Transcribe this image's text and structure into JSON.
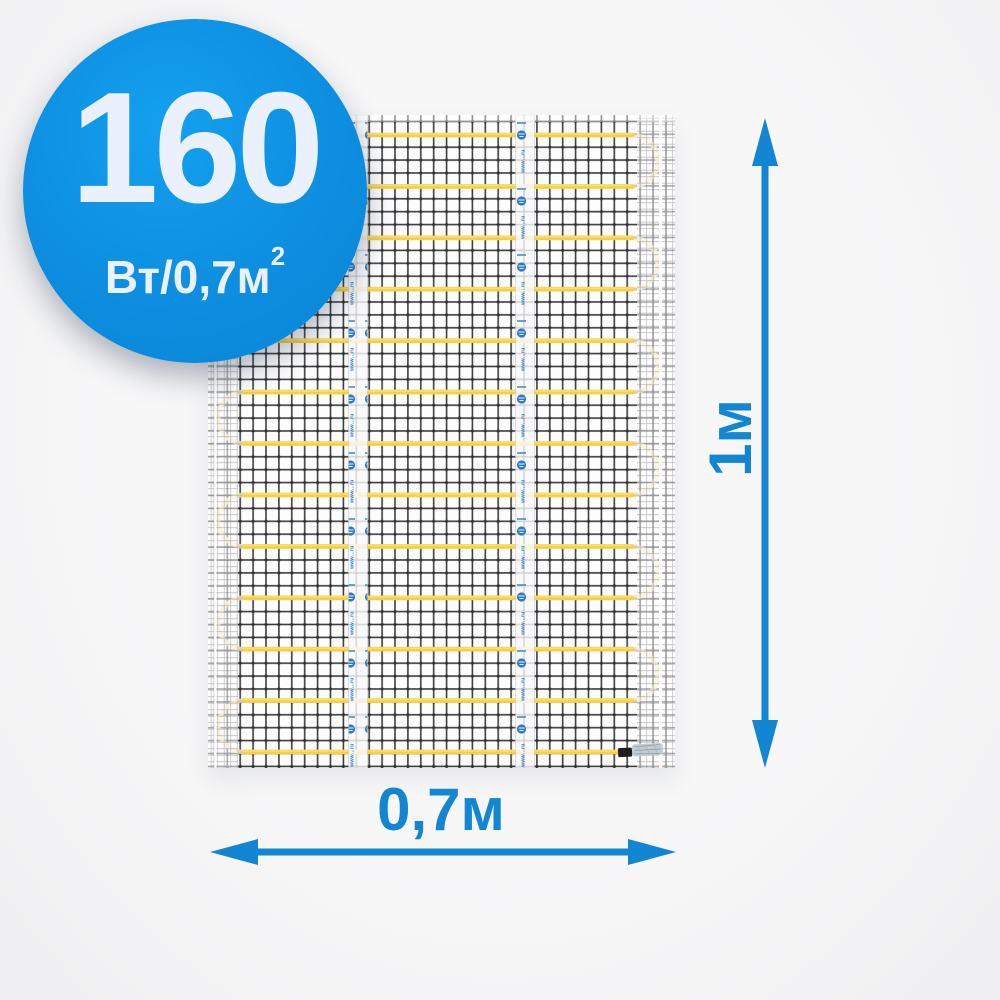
{
  "badge": {
    "value": "160",
    "unit_base": "Вт/0,7м",
    "unit_exponent": "2",
    "background_color": "#0d8ee0",
    "text_color": "#eaf0fc"
  },
  "mat": {
    "tape_watermark": "www…ru",
    "cable_color": "#f6cf45",
    "cable_turn_color": "#eedfb2",
    "mesh_color": "#222222",
    "cable_runs": 13
  },
  "dimensions": {
    "height_label": "1м",
    "width_label": "0,7м",
    "arrow_color": "#1286d3"
  }
}
